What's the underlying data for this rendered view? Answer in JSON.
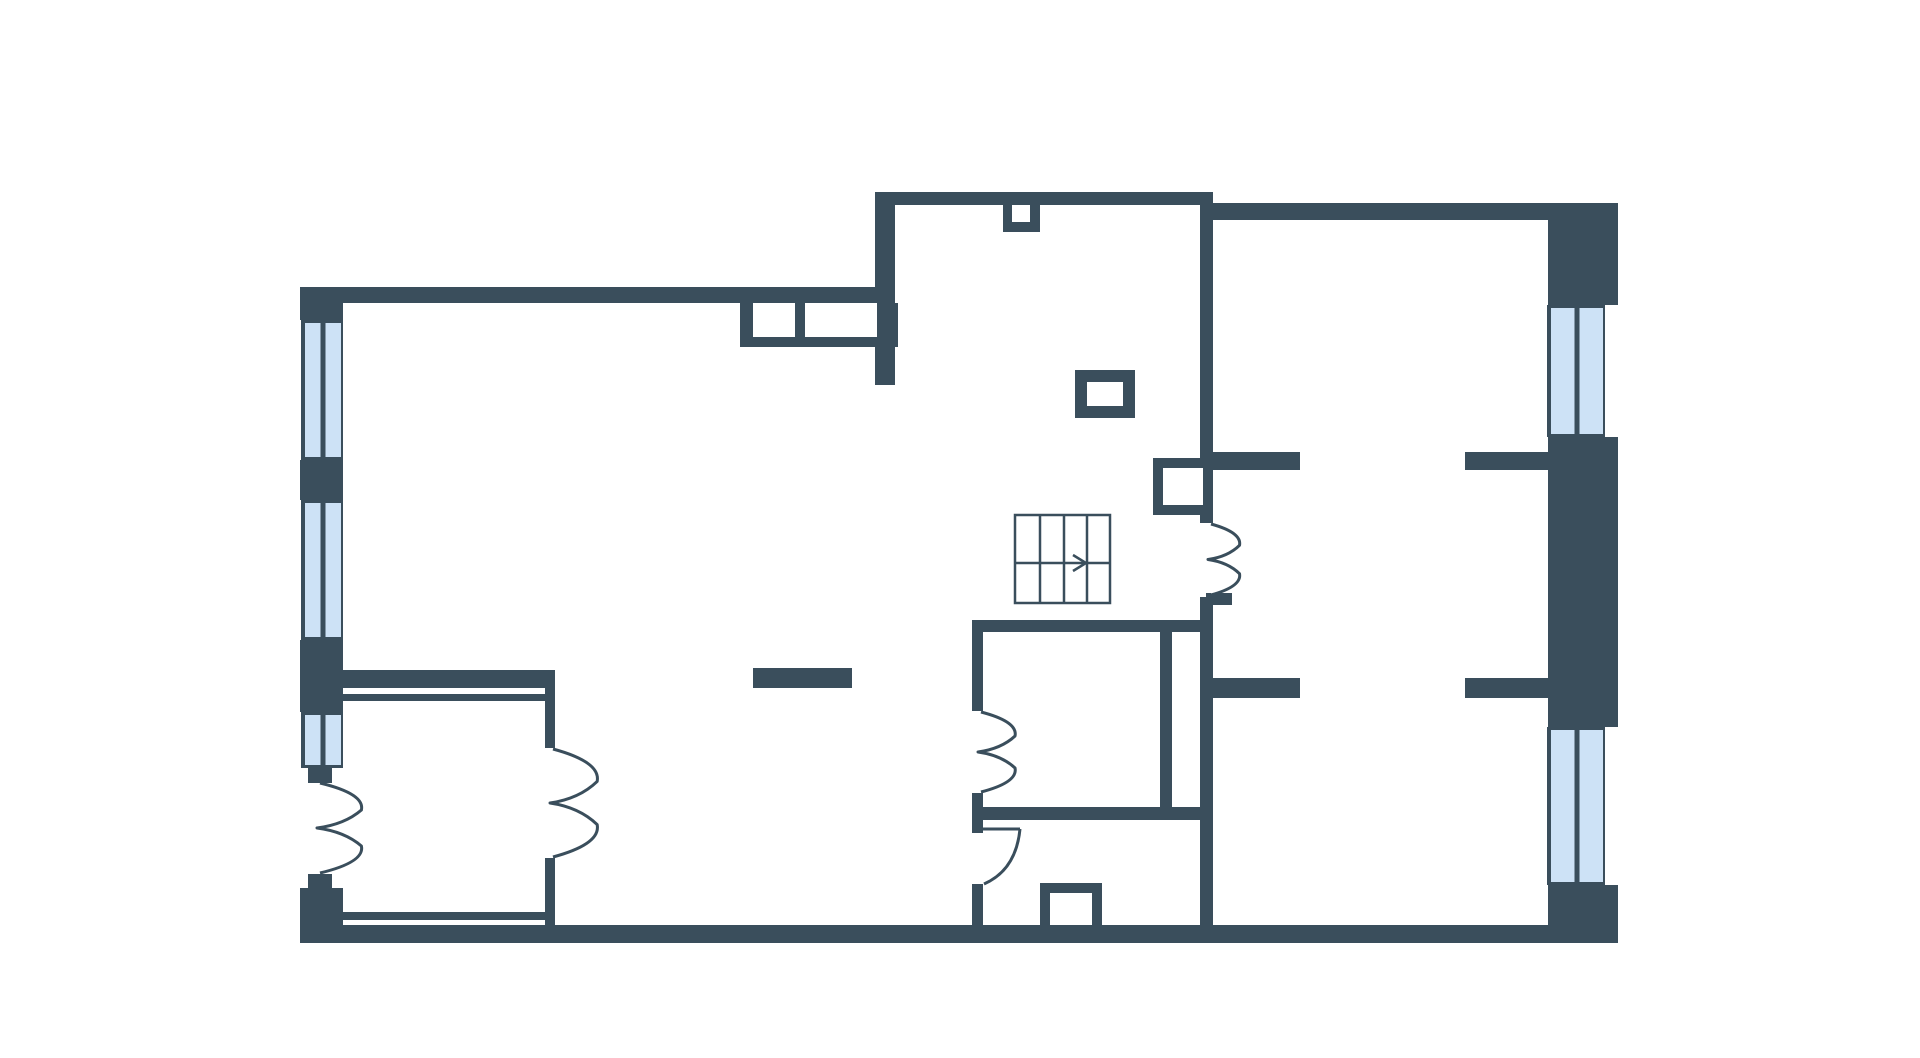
{
  "canvas": {
    "width": 1920,
    "height": 1058
  },
  "palette": {
    "floor": "#ffffff",
    "wall": "#3a4e5c",
    "window_fill": "#cde2f6",
    "window_stroke": "#3a4e5c",
    "door_stroke": "#3a4e5c",
    "stair_stroke": "#3a4e5c",
    "stair_fill": "#ffffff"
  },
  "plan": {
    "wall_rects": [
      {
        "name": "left-wall-corner-top",
        "r": [
          300,
          287,
          43,
          33
        ]
      },
      {
        "name": "left-wall-pier-1",
        "r": [
          300,
          460,
          43,
          40
        ]
      },
      {
        "name": "left-wall-pier-2",
        "r": [
          300,
          640,
          43,
          72
        ]
      },
      {
        "name": "left-door-jamb-top",
        "r": [
          308,
          768,
          24,
          15
        ]
      },
      {
        "name": "left-door-jamb-bottom",
        "r": [
          308,
          874,
          24,
          14
        ]
      },
      {
        "name": "left-wall-corner-bottom",
        "r": [
          300,
          888,
          43,
          55
        ]
      },
      {
        "name": "top-wall-west",
        "r": [
          300,
          287,
          577,
          16
        ]
      },
      {
        "name": "hall-west-wall",
        "r": [
          875,
          192,
          20,
          193
        ]
      },
      {
        "name": "top-wall-middle",
        "r": [
          875,
          192,
          338,
          13
        ]
      },
      {
        "name": "top-niche-block",
        "r": [
          1003,
          205,
          37,
          27
        ]
      },
      {
        "name": "hall-east-wall-upper",
        "r": [
          1200,
          192,
          13,
          331
        ]
      },
      {
        "name": "hall-east-wall-lower",
        "r": [
          1200,
          597,
          13,
          346
        ]
      },
      {
        "name": "hall-door-sill",
        "r": [
          1206,
          593,
          26,
          12
        ]
      },
      {
        "name": "top-wall-east",
        "r": [
          1213,
          203,
          335,
          17
        ]
      },
      {
        "name": "right-wall-block-top",
        "r": [
          1548,
          203,
          70,
          102
        ]
      },
      {
        "name": "right-wall-block-mid",
        "r": [
          1548,
          437,
          70,
          290
        ]
      },
      {
        "name": "right-wall-block-bottom",
        "r": [
          1548,
          885,
          70,
          58
        ]
      },
      {
        "name": "bottom-wall",
        "r": [
          300,
          925,
          1318,
          18
        ]
      },
      {
        "name": "partition-stub-upper-west",
        "r": [
          1213,
          452,
          87,
          18
        ]
      },
      {
        "name": "partition-stub-upper-east",
        "r": [
          1465,
          452,
          83,
          18
        ]
      },
      {
        "name": "partition-stub-lower-west",
        "r": [
          1213,
          678,
          87,
          20
        ]
      },
      {
        "name": "partition-stub-lower-east",
        "r": [
          1465,
          678,
          83,
          20
        ]
      },
      {
        "name": "closet-top-wall",
        "r": [
          343,
          670,
          212,
          18
        ]
      },
      {
        "name": "closet-top-inner-line",
        "r": [
          343,
          694,
          212,
          7
        ]
      },
      {
        "name": "closet-east-wall-upper",
        "r": [
          545,
          670,
          10,
          78
        ]
      },
      {
        "name": "closet-east-wall-lower",
        "r": [
          545,
          858,
          10,
          67
        ]
      },
      {
        "name": "closet-bottom-inner-line",
        "r": [
          343,
          912,
          212,
          8
        ]
      },
      {
        "name": "kitchen-bar",
        "r": [
          753,
          668,
          99,
          20
        ]
      },
      {
        "name": "counter-frame",
        "r": [
          740,
          303,
          158,
          44
        ]
      },
      {
        "name": "roomA-top-wall",
        "r": [
          972,
          620,
          230,
          12
        ]
      },
      {
        "name": "roomA-west-wall-upper",
        "r": [
          972,
          620,
          11,
          91
        ]
      },
      {
        "name": "roomA-west-wall-lower",
        "r": [
          972,
          793,
          11,
          27
        ]
      },
      {
        "name": "roomA-bottom-wall",
        "r": [
          972,
          807,
          230,
          13
        ]
      },
      {
        "name": "roomA-divider",
        "r": [
          1160,
          632,
          12,
          175
        ]
      },
      {
        "name": "roomB-west-jamb",
        "r": [
          972,
          820,
          11,
          13
        ]
      },
      {
        "name": "roomB-west-wall-lower",
        "r": [
          972,
          884,
          11,
          41
        ]
      },
      {
        "name": "bottom-box",
        "r": [
          1040,
          883,
          62,
          42
        ]
      },
      {
        "name": "stair-shaft-box",
        "r": [
          1153,
          458,
          60,
          57
        ]
      },
      {
        "name": "hall-column-box",
        "r": [
          1075,
          370,
          60,
          48
        ]
      }
    ],
    "white_rects": [
      {
        "name": "counter-hole-1",
        "r": [
          753,
          303,
          42,
          34
        ]
      },
      {
        "name": "counter-hole-2",
        "r": [
          805,
          303,
          72,
          34
        ]
      },
      {
        "name": "top-niche-hole",
        "r": [
          1012,
          205,
          18,
          17
        ]
      },
      {
        "name": "stair-shaft-hole",
        "r": [
          1163,
          468,
          40,
          37
        ]
      },
      {
        "name": "hall-column-hole",
        "r": [
          1087,
          382,
          36,
          24
        ]
      },
      {
        "name": "bottom-box-hole",
        "r": [
          1050,
          893,
          42,
          32
        ]
      }
    ],
    "windows": [
      {
        "name": "window-left-1",
        "r": [
          303,
          320,
          38,
          140
        ]
      },
      {
        "name": "window-left-2",
        "r": [
          303,
          500,
          38,
          140
        ]
      },
      {
        "name": "window-left-3",
        "r": [
          303,
          712,
          38,
          56
        ]
      },
      {
        "name": "window-right-upper",
        "r": [
          1549,
          305,
          54,
          132
        ]
      },
      {
        "name": "window-right-lower",
        "r": [
          1549,
          727,
          54,
          158
        ]
      }
    ],
    "stairs": {
      "name": "staircase",
      "box": [
        1015,
        515,
        95,
        88
      ],
      "treads_x": [
        1040,
        1064,
        1087
      ],
      "mid_y": 563,
      "arrow_head": [
        [
          1073,
          555
        ],
        [
          1086,
          563
        ],
        [
          1073,
          571
        ]
      ]
    },
    "petal_doors": [
      {
        "name": "entrance-door",
        "x": 320,
        "y1": 783,
        "y2": 873,
        "reach": 45
      },
      {
        "name": "closet-door",
        "x": 553,
        "y1": 749,
        "y2": 857,
        "reach": 48
      },
      {
        "name": "roomA-door",
        "x": 981,
        "y1": 712,
        "y2": 792,
        "reach": 37
      },
      {
        "name": "hall-east-door",
        "x": 1211,
        "y1": 524,
        "y2": 595,
        "reach": 31
      }
    ],
    "quarter_doors": [
      {
        "name": "roomB-door",
        "leaf": [
          983,
          829,
          1020,
          829
        ],
        "arc_from": [
          1020,
          829
        ],
        "arc_ctrl": [
          1016,
          870
        ],
        "arc_to": [
          984,
          884
        ]
      }
    ]
  }
}
